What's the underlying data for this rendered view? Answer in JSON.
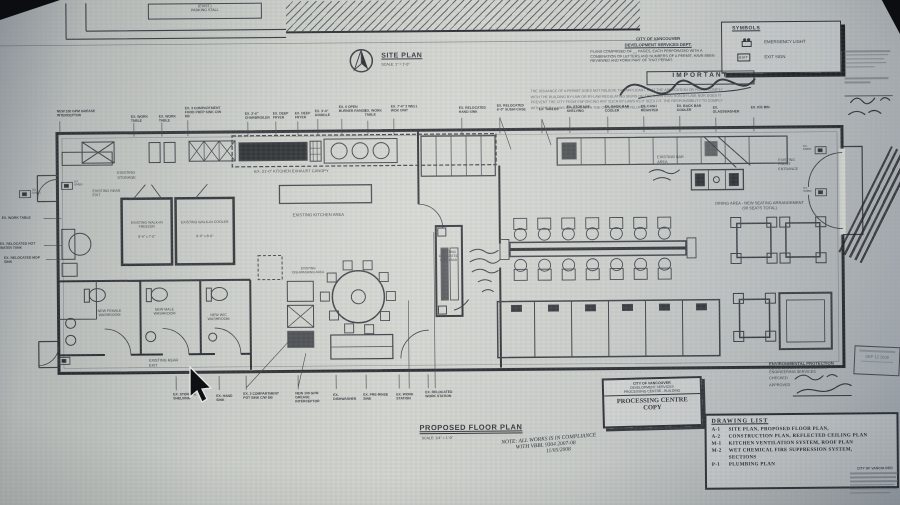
{
  "site_plan": {
    "title": "SITE PLAN",
    "scale": "SCALE: 1\" = 1'-0\"",
    "parking_label": "(EXIST.)\nPARKING STALL"
  },
  "cov_header": {
    "dept_line1": "CITY OF VANCOUVER",
    "dept_line2": "DEVELOPMENT SERVICES DEPT.",
    "plans_note": "PLANS COMPRISED OF __ PAGES, EACH PERFORATED WITH A COMBINATION OF LETTERS AND NUMBERS OF A PERMIT, HAVE BEEN REVIEWED AND FORM PART OF THAT PERMIT.",
    "important": "IMPORTANT",
    "fine_print": "THE ISSUANCE OF A PERMIT DOES NOT RELIEVE THE APPLICANT THAT THE APPLICATION OR PLANS COMPLY WITH THE BUILDING BY-LAW OR BY-LAW REGULATING SIGNS OR THE CONSTRUCTION BY-LAW, NOR DOES IT PREVENT THE CITY FROM ENFORCING ANY SUCH BY-LAWS AS IT SEES FIT. THE RESPONSIBILITY TO COMPLY WITH THE BY-LAWS REMAINS WITH THE OWNER AND DEVELOPER."
  },
  "symbols": {
    "title": "SYMBOLS",
    "emergency_label": "EMERGENCY LIGHT",
    "exit_label": "EXIT SIGN",
    "exit_glyph": "EXIT"
  },
  "plan": {
    "storage": "EXISTING STORAGE",
    "rear_exit_top": "EXISTING REAR EXIT",
    "rear_exit_bottom": "EXISTING REAR EXIT",
    "freezer_name": "EXISTING WALK-IN FREEZER",
    "freezer_size": "8'-6\" x 7'-0\"",
    "cooler_name": "EXISTING WALK-IN COOLER",
    "cooler_size": "8'-6\" x 8'-0\"",
    "canopy": "EX. 21'-0\" KITCHEN EXHAUST CANOPY",
    "kitchen_area": "EXISTING KITCHEN AREA",
    "dishwashing": "EXISTING DISHWASHING AREA",
    "female_wr": "NEW FEMALE WASHROOM",
    "male_wr": "NEW MALE WASHROOM",
    "wc_wr": "NEW W/C WASHROOM",
    "sushi_bar": "EXISTING RELOCATED SUSHI BAR",
    "bar_area": "EXISTING BAR AREA",
    "front_entrance": "EXISTING FRONT ENTRANCE",
    "dining": "DINING AREA - NEW SEATING ARRANGEMENT\n(90 SEATS TOTAL)",
    "emer": "EX.\nEMER."
  },
  "callouts_top": [
    "NEW 100 GPM GREASE INTERCEPTOR",
    "EX. WORK TABLE",
    "EX. WORK TABLE",
    "EX. 3 COMPARTMENT FOOD PREP SINK C/W DB",
    "EX. 2'-6\" CHARBROILER",
    "EX. DEEP FRYER",
    "EX. DEEP FRYER",
    "EX. 3'-0\" GRIDDLE",
    "EX. 6 OPEN BURNER RANGE",
    "EX. WORK TABLE",
    "EX. 7'-6\" 2 WELL WOK UNIT",
    "EX. RELOCATED HAND SINK",
    "EX. RELOCATED 6'-0\" SUSHI CASE",
    "EX. TABLES",
    "EX. STORAGE SHELVING",
    "EX. BACK BAR COOLER",
    "EX. CASH REGISTER",
    "EX. BACK BAR COOLER",
    "EX. GLASSWASHER",
    "EX. ICE BIN"
  ],
  "callouts_bottom": [
    "EX. STORAGE SHELVING",
    "EX. HAND SINK",
    "EX. 3 COMPARTMENT POT SINK C/W DB",
    "NEW 100 GPM GREASE INTERCEPTOR",
    "EX. DISHWASHER",
    "EX. PRE-RINSE SINK",
    "EX. WORK STATION",
    "EX. RELOCATED WORK STATION"
  ],
  "callouts_left": [
    "EX. WORK TABLE",
    "EX. RELOCATED HOT WATER TANK",
    "EX. RELOCATED MOP SINK"
  ],
  "title_block": {
    "title": "PROPOSED FLOOR PLAN",
    "scale": "SCALE: 1/4\" = 1'-0\""
  },
  "hand_note": {
    "line1": "NOTE: ALL WORKS IS IN COMPLIANCE",
    "line2": "WITH VBBL 9304 2007-08",
    "date": "11/05/2008"
  },
  "processing_stamp": {
    "l1": "CITY OF VANCOUVER",
    "l2": "DEVELOPMENT SERVICES",
    "l3": "PROCESSING CENTRE - BUILDING",
    "big1": "PROCESSING CENTRE",
    "big2": "COPY"
  },
  "env_block": {
    "l1": "ENVIRONMENTAL PROTECTION",
    "l2": "SEWERS & DRAINAGE DESIGN,",
    "l3": "ENGINEERING SERVICES",
    "checked": "CHECKED",
    "approved": "APPROVED"
  },
  "date_stamp": {
    "text": "SEP 12 2008"
  },
  "right_margin": {
    "city": "CITY OF VANCOUVER"
  },
  "drawing_list": {
    "title": "DRAWING LIST",
    "items": [
      {
        "code": "A-1",
        "name": "SITE PLAN, PROPOSED FLOOR PLAN,"
      },
      {
        "code": "A-2",
        "name": "CONSTRUCTION PLAN, REFLECTED CEILING PLAN"
      },
      {
        "code": "M-1",
        "name": "KITCHEN VENTILATION SYSTEM, ROOF PLAN"
      },
      {
        "code": "M-2",
        "name": "WET CHEMICAL FIRE SUPPRESSION SYSTEM,\nSECTIONS"
      },
      {
        "code": "P-1",
        "name": "PLUMBING PLAN"
      }
    ]
  }
}
